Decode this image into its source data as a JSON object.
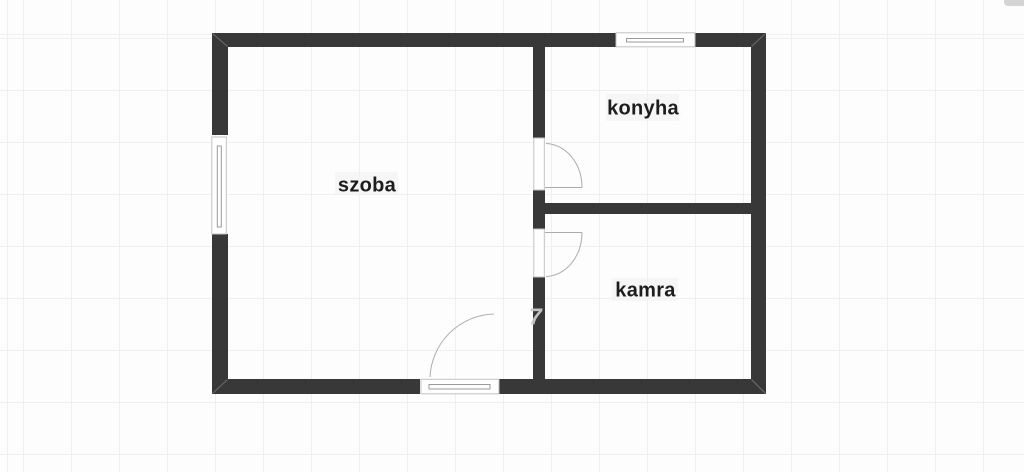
{
  "plan": {
    "rooms": [
      {
        "label": "szoba"
      },
      {
        "label": "konyha"
      },
      {
        "label": "kamra"
      }
    ],
    "watermark": {
      "text": "7"
    },
    "fixtures": {
      "windows": [
        "left-window",
        "top-window"
      ],
      "doors": [
        "entrance-door",
        "konyha-door",
        "kamra-door"
      ]
    },
    "colors": {
      "wall": "#383838",
      "background": "#fdfdfd",
      "grid_line": "#f0f0f0",
      "room_label": "#1d1d1d",
      "fixture_frame": "#c2c2c2",
      "fixture_line": "#9a9a9a",
      "door_swing": "#a3a3a3",
      "watermark": "#c9c9c9"
    }
  }
}
